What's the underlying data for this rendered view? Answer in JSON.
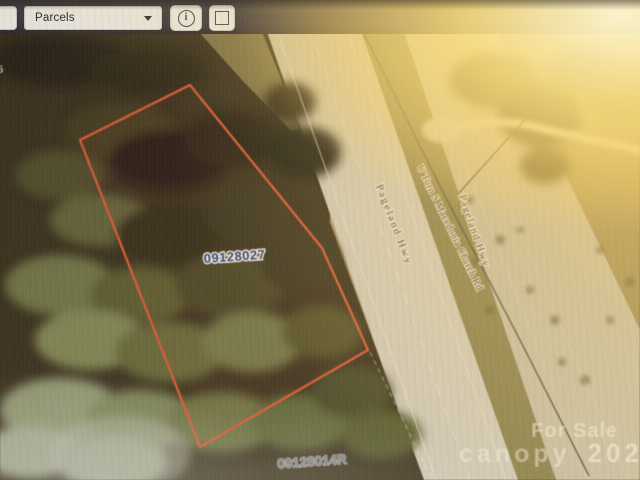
{
  "toolbar": {
    "layer_dropdown": {
      "value": "Parcels"
    },
    "icons": {
      "dropdown_chevron": "chevron-down",
      "info_button": "info-circle",
      "draw_button": "square-outline"
    }
  },
  "map": {
    "parcel_labels": [
      {
        "id": "09128027"
      },
      {
        "id": "09128014R"
      }
    ],
    "road_labels": {
      "left_hwy": "Pageland Hwy",
      "church_rd": "U Turn S Macedonia Church Rd",
      "right_hwy": "Pageland Hwy"
    },
    "partial_route_number": "45",
    "outline_color": "#e2502d"
  },
  "watermark": {
    "line1": "For Sale",
    "brand": "canopy",
    "year": "2025"
  }
}
